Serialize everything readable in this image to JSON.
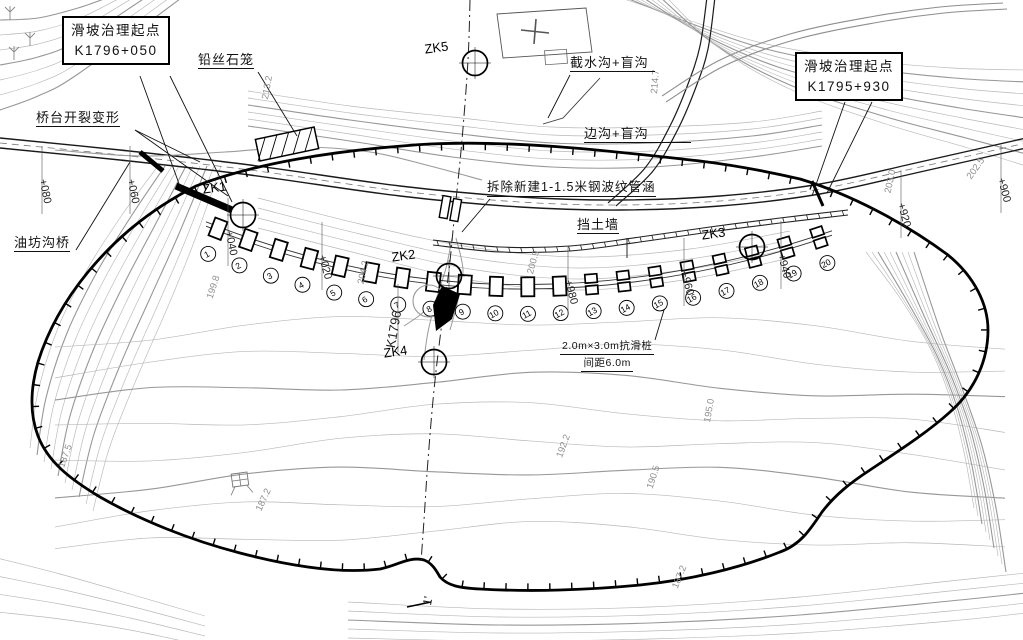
{
  "title_boxes": {
    "left": {
      "line1": "滑坡治理起点",
      "line2": "K1796+050"
    },
    "right": {
      "line1": "滑坡治理起点",
      "line2": "K1795+930"
    }
  },
  "feature_labels": {
    "gabion": "铅丝石笼",
    "abutment_crack": "桥台开裂变形",
    "bridge": "油坊沟桥",
    "intercept_drain": "截水沟+盲沟",
    "side_drain": "边沟+盲沟",
    "culvert_note": "拆除新建1-1.5米钢波纹管涵",
    "retaining_wall": "挡土墙",
    "pile_note_line1": "2.0m×3.0m抗滑桩",
    "pile_note_line2": "间距6.0m",
    "section_end_mark": "1'"
  },
  "boreholes": [
    "ZK1",
    "ZK2",
    "ZK3",
    "ZK4",
    "ZK5"
  ],
  "stations": [
    "+080",
    "+060",
    "+040",
    "+020",
    "K1796",
    "+980",
    "+960",
    "+940",
    "+920",
    "+900"
  ],
  "pile_numbers": [
    "1",
    "2",
    "3",
    "4",
    "5",
    "6",
    "7",
    "8",
    "9",
    "10",
    "11",
    "12",
    "13",
    "14",
    "15",
    "16",
    "17",
    "18",
    "19",
    "20"
  ],
  "contour_elevations": [
    "213.2",
    "214.7",
    "203.0",
    "202.5",
    "200.9",
    "204.2",
    "199.8",
    "187.5",
    "187.2",
    "192.2",
    "190.5",
    "195.0",
    "187.2"
  ],
  "colors": {
    "background": "#ffffff",
    "line": "#1a1a1a",
    "contour": "#b8b8b8",
    "contour_index": "#979797",
    "boundary": "#000000",
    "elevation_text": "#8f8f8f"
  }
}
